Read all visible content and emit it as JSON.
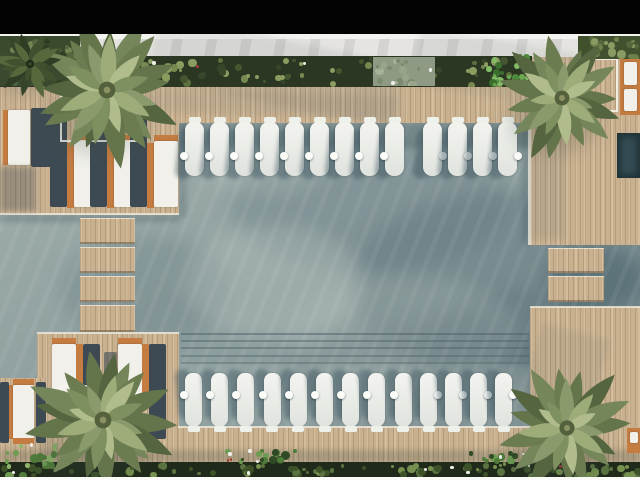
{
  "meta": {
    "title": "Aerial top-down render of resort swimming pool with sun deck",
    "type": "architectural-render",
    "visible_text": []
  },
  "palette": {
    "letterbox_black": "#030303",
    "walkway_white": "#f3f3f0",
    "marble_gray": "#e5e4e0",
    "deck_wood": "#c9b190",
    "water_base": "#95a5a4",
    "water_shadow": "#5a6f78",
    "lounger_white": "#f1f0ea",
    "lounger_frame_orange": "#c47c41",
    "furniture_shadow": "#3d4a53",
    "planter_green_dark": "#2b3722",
    "palm_green": "#7e8f60",
    "spa_teal": "#203439"
  },
  "scene": {
    "water_fx": [
      {
        "k": "blob",
        "x": 230,
        "y": 140,
        "w": 280,
        "h": 130,
        "c": "#5f757e",
        "o": 0.3
      },
      {
        "k": "blob",
        "x": 350,
        "y": 190,
        "w": 330,
        "h": 190,
        "c": "#5a6f78",
        "o": 0.36
      },
      {
        "k": "blob",
        "x": 60,
        "y": 235,
        "w": 170,
        "h": 110,
        "c": "#61767d",
        "o": 0.28
      },
      {
        "k": "blob",
        "x": 545,
        "y": 247,
        "w": 100,
        "h": 64,
        "c": "#3f5b65",
        "o": 0.45
      },
      {
        "k": "blob",
        "x": 290,
        "y": 320,
        "w": 300,
        "h": 120,
        "c": "#5e7077",
        "o": 0.28
      },
      {
        "k": "blob",
        "x": 420,
        "y": 290,
        "w": 230,
        "h": 150,
        "c": "#566c74",
        "o": 0.32
      },
      {
        "k": "blob",
        "x": 185,
        "y": 225,
        "w": 180,
        "h": 115,
        "c": "#c3cdc7",
        "o": 0.28
      },
      {
        "k": "blob",
        "x": 290,
        "y": 275,
        "w": 230,
        "h": 120,
        "c": "#bcc7c1",
        "o": 0.2
      },
      {
        "k": "blob",
        "x": 200,
        "y": 133,
        "w": 130,
        "h": 62,
        "c": "#c3cdc7",
        "o": 0.2
      },
      {
        "k": "blob",
        "x": 440,
        "y": 368,
        "w": 170,
        "h": 72,
        "c": "#b5c0ba",
        "o": 0.16
      },
      {
        "k": "streaks",
        "x": 0,
        "y": 86,
        "w": 640,
        "h": 380
      },
      {
        "k": "shade",
        "x": 178,
        "y": 122,
        "w": 352,
        "h": 26,
        "c": "#2a4049",
        "o": 0.28
      },
      {
        "k": "shade",
        "x": 179,
        "y": 122,
        "w": 7,
        "h": 95,
        "c": "#2a4049",
        "o": 0.25
      },
      {
        "k": "shade",
        "x": 522,
        "y": 122,
        "w": 8,
        "h": 123,
        "c": "#2a4049",
        "o": 0.22
      },
      {
        "k": "shade",
        "x": 0,
        "y": 215,
        "w": 179,
        "h": 7,
        "c": "#2a4049",
        "o": 0.25
      },
      {
        "k": "line",
        "x": 181,
        "y": 333,
        "w": 348,
        "h": 2,
        "c": "#4c6067",
        "o": 0.5
      },
      {
        "k": "line",
        "x": 181,
        "y": 340,
        "w": 348,
        "h": 2,
        "c": "#4c6067",
        "o": 0.45
      },
      {
        "k": "line",
        "x": 181,
        "y": 347,
        "w": 348,
        "h": 2,
        "c": "#4c6067",
        "o": 0.45
      },
      {
        "k": "line",
        "x": 181,
        "y": 355,
        "w": 348,
        "h": 2,
        "c": "#4c6067",
        "o": 0.4
      },
      {
        "k": "line",
        "x": 181,
        "y": 362,
        "w": 348,
        "h": 2,
        "c": "#4c6067",
        "o": 0.38
      },
      {
        "k": "shade",
        "x": 180,
        "y": 365,
        "w": 349,
        "h": 62,
        "c": "#cfd8d2",
        "o": 0.13
      }
    ],
    "decks": [
      {
        "k": "wood",
        "x": 0,
        "y": 86,
        "w": 640,
        "h": 37
      },
      {
        "k": "wood",
        "x": 530,
        "y": 57,
        "w": 110,
        "h": 188
      },
      {
        "k": "wood",
        "x": 530,
        "y": 307,
        "w": 110,
        "h": 158
      },
      {
        "k": "wood",
        "x": 0,
        "y": 86,
        "w": 179,
        "h": 129
      },
      {
        "k": "wood",
        "x": 37,
        "y": 333,
        "w": 142,
        "h": 132
      },
      {
        "k": "wood",
        "x": 0,
        "y": 378,
        "w": 46,
        "h": 87
      },
      {
        "k": "wood",
        "x": 178,
        "y": 427,
        "w": 462,
        "h": 38
      },
      {
        "k": "step",
        "x": 80,
        "y": 218,
        "w": 55,
        "h": 26
      },
      {
        "k": "step",
        "x": 80,
        "y": 247,
        "w": 55,
        "h": 26
      },
      {
        "k": "step",
        "x": 80,
        "y": 276,
        "w": 55,
        "h": 26
      },
      {
        "k": "step",
        "x": 80,
        "y": 305,
        "w": 55,
        "h": 27
      },
      {
        "k": "step",
        "x": 548,
        "y": 248,
        "w": 56,
        "h": 25
      },
      {
        "k": "step",
        "x": 548,
        "y": 276,
        "w": 56,
        "h": 26
      },
      {
        "k": "coping",
        "x": 528,
        "y": 120,
        "w": 3,
        "h": 125
      },
      {
        "k": "coping",
        "x": 530,
        "y": 306,
        "w": 110,
        "h": 2
      },
      {
        "k": "coping",
        "x": 178,
        "y": 426,
        "w": 352,
        "h": 2
      },
      {
        "k": "coping",
        "x": 0,
        "y": 213,
        "w": 179,
        "h": 2
      },
      {
        "k": "coping",
        "x": 37,
        "y": 332,
        "w": 142,
        "h": 2
      }
    ],
    "deck_shadows": [
      {
        "k": "shade",
        "x": 150,
        "y": 38,
        "w": 250,
        "h": 66,
        "c": "#55656b",
        "o": 0.1,
        "rot": 12
      },
      {
        "k": "shade",
        "x": 415,
        "y": 40,
        "w": 160,
        "h": 58,
        "c": "#55656b",
        "o": 0.09,
        "rot": 9
      },
      {
        "k": "shade",
        "x": 530,
        "y": 90,
        "w": 36,
        "h": 150,
        "c": "#4e5e63",
        "o": 0.12
      },
      {
        "k": "shade",
        "x": 140,
        "y": 92,
        "w": 260,
        "h": 24,
        "c": "#55656b",
        "o": 0.1,
        "rot": 2
      },
      {
        "k": "shade",
        "x": 530,
        "y": 330,
        "w": 70,
        "h": 90,
        "c": "#4e5e63",
        "o": 0.1,
        "rot": 15
      },
      {
        "k": "shade",
        "x": 0,
        "y": 450,
        "w": 640,
        "h": 13,
        "c": "#333f34",
        "o": 0.22
      }
    ],
    "furniture": [
      {
        "k": "frame",
        "x": 3,
        "y": 110,
        "w": 5,
        "h": 55
      },
      {
        "k": "cushion",
        "x": 8,
        "y": 110,
        "w": 22,
        "h": 55
      },
      {
        "k": "shadow",
        "x": 31,
        "y": 108,
        "w": 23,
        "h": 59
      },
      {
        "k": "shade",
        "x": 0,
        "y": 167,
        "w": 36,
        "h": 44,
        "c": "#3e4b54",
        "o": 0.35
      },
      {
        "k": "shadow",
        "x": 50,
        "y": 110,
        "w": 17,
        "h": 97
      },
      {
        "k": "frame",
        "x": 67,
        "y": 143,
        "w": 7,
        "h": 65
      },
      {
        "k": "cap",
        "x": 74,
        "y": 135,
        "w": 24,
        "h": 7
      },
      {
        "k": "cushion",
        "x": 74,
        "y": 141,
        "w": 24,
        "h": 66
      },
      {
        "k": "shadow",
        "x": 90,
        "y": 110,
        "w": 17,
        "h": 97
      },
      {
        "k": "frame",
        "x": 107,
        "y": 143,
        "w": 7,
        "h": 65
      },
      {
        "k": "cap",
        "x": 114,
        "y": 135,
        "w": 24,
        "h": 7
      },
      {
        "k": "cushion",
        "x": 114,
        "y": 141,
        "w": 24,
        "h": 66
      },
      {
        "k": "shadow",
        "x": 130,
        "y": 110,
        "w": 17,
        "h": 97
      },
      {
        "k": "frame",
        "x": 147,
        "y": 143,
        "w": 7,
        "h": 65
      },
      {
        "k": "cap",
        "x": 154,
        "y": 135,
        "w": 24,
        "h": 7
      },
      {
        "k": "cushion",
        "x": 154,
        "y": 141,
        "w": 24,
        "h": 66
      },
      {
        "k": "cap",
        "x": 52,
        "y": 338,
        "w": 24,
        "h": 7
      },
      {
        "k": "cushion",
        "x": 52,
        "y": 344,
        "w": 24,
        "h": 63
      },
      {
        "k": "cap",
        "x": 52,
        "y": 406,
        "w": 24,
        "h": 7
      },
      {
        "k": "frame",
        "x": 76,
        "y": 344,
        "w": 7,
        "h": 63
      },
      {
        "k": "shadow",
        "x": 83,
        "y": 344,
        "w": 17,
        "h": 95
      },
      {
        "k": "cap",
        "x": 118,
        "y": 338,
        "w": 24,
        "h": 7
      },
      {
        "k": "cushion",
        "x": 118,
        "y": 344,
        "w": 24,
        "h": 63
      },
      {
        "k": "cap",
        "x": 118,
        "y": 406,
        "w": 24,
        "h": 7
      },
      {
        "k": "frame",
        "x": 142,
        "y": 344,
        "w": 7,
        "h": 63
      },
      {
        "k": "shadow",
        "x": 149,
        "y": 344,
        "w": 17,
        "h": 95
      },
      {
        "k": "shadow",
        "x": 104,
        "y": 352,
        "w": 13,
        "h": 80,
        "o": 0.6
      },
      {
        "k": "shadow",
        "x": 0,
        "y": 382,
        "w": 9,
        "h": 61
      },
      {
        "k": "frame",
        "x": 9,
        "y": 385,
        "w": 4,
        "h": 54
      },
      {
        "k": "cap",
        "x": 13,
        "y": 379,
        "w": 21,
        "h": 6
      },
      {
        "k": "cushion",
        "x": 13,
        "y": 385,
        "w": 21,
        "h": 54
      },
      {
        "k": "cap",
        "x": 13,
        "y": 438,
        "w": 21,
        "h": 6
      },
      {
        "k": "shadow",
        "x": 36,
        "y": 382,
        "w": 10,
        "h": 61
      },
      {
        "k": "frame",
        "x": 620,
        "y": 58,
        "w": 20,
        "h": 57
      },
      {
        "k": "cushion",
        "x": 624,
        "y": 62,
        "w": 13,
        "h": 23
      },
      {
        "k": "cushion",
        "x": 624,
        "y": 89,
        "w": 13,
        "h": 22
      },
      {
        "k": "spa",
        "x": 617,
        "y": 133,
        "w": 23,
        "h": 45
      },
      {
        "k": "shade",
        "x": 621,
        "y": 137,
        "w": 15,
        "h": 37,
        "c": "#46626c",
        "o": 0.5
      },
      {
        "k": "frame",
        "x": 627,
        "y": 428,
        "w": 13,
        "h": 25
      },
      {
        "k": "cushion",
        "x": 630,
        "y": 432,
        "w": 8,
        "h": 11
      },
      {
        "k": "box",
        "x": 60,
        "y": 95,
        "w": 78,
        "h": 47
      },
      {
        "k": "box",
        "x": 586,
        "y": 58,
        "w": 32,
        "h": 54
      },
      {
        "k": "box",
        "x": 60,
        "y": 385,
        "w": 78,
        "h": 45
      }
    ],
    "pool_lounger_rows": [
      {
        "x": 185,
        "y": 122,
        "w": 19,
        "h": 54,
        "count": 9,
        "pitch": 25,
        "dot_y": 152,
        "dot_side": "left",
        "edge": "top"
      },
      {
        "x": 423,
        "y": 122,
        "w": 19,
        "h": 54,
        "count": 4,
        "pitch": 25,
        "dot_y": 152,
        "dot_side": "right",
        "edge": "top"
      },
      {
        "x": 185,
        "y": 373,
        "w": 17,
        "h": 54,
        "count": 9,
        "pitch": 26.2,
        "dot_y": 391,
        "dot_side": "left",
        "edge": "bottom"
      },
      {
        "x": 420,
        "y": 373,
        "w": 17,
        "h": 54,
        "count": 4,
        "pitch": 25,
        "dot_y": 391,
        "dot_side": "right",
        "edge": "bottom"
      }
    ],
    "plant_zones": [
      {
        "x": 0,
        "y": 56,
        "w": 532,
        "h": 31,
        "bg": "#2b3722",
        "n": 95,
        "palette": [
          "#44562f",
          "#5c7040",
          "#778950",
          "#36472a",
          "#8c9c61"
        ],
        "white": 6,
        "red": 3
      },
      {
        "x": 373,
        "y": 57,
        "w": 62,
        "h": 29,
        "bg": "#8f9a85",
        "n": 18,
        "palette": [
          "#a8b29b",
          "#7c8a6d",
          "#98a58a"
        ],
        "white": 2,
        "red": 0
      },
      {
        "x": 578,
        "y": 36,
        "w": 62,
        "h": 23,
        "bg": "#42512d",
        "n": 22,
        "palette": [
          "#55673c",
          "#6d7f4b",
          "#8a9a63"
        ],
        "white": 0,
        "red": 0
      },
      {
        "x": 0,
        "y": 36,
        "w": 80,
        "h": 50,
        "bg": "#3b4a2d",
        "n": 28,
        "palette": [
          "#2f3d22",
          "#55683f",
          "#738553",
          "#465733"
        ],
        "white": 0,
        "red": 0
      },
      {
        "x": 486,
        "y": 48,
        "w": 48,
        "h": 42,
        "bg": "",
        "n": 24,
        "palette": [
          "#4e8a3c",
          "#6aa94f",
          "#3c6e2e",
          "#83bb66"
        ],
        "white": 0,
        "red": 0
      },
      {
        "x": 0,
        "y": 462,
        "w": 640,
        "h": 15,
        "bg": "#1f2a1a",
        "n": 95,
        "palette": [
          "#3d5229",
          "#5a7340",
          "#76914f"
        ],
        "white": 7,
        "red": 3
      },
      {
        "x": 2,
        "y": 442,
        "w": 55,
        "h": 36,
        "bg": "",
        "n": 18,
        "palette": [
          "#4f7c3a",
          "#6e9c52",
          "#8fb56b"
        ],
        "white": 2,
        "red": 0
      },
      {
        "x": 225,
        "y": 448,
        "w": 75,
        "h": 16,
        "bg": "",
        "n": 16,
        "palette": [
          "#4f7c3a",
          "#6e9c52",
          "#2f4a24"
        ],
        "white": 3,
        "red": 2
      },
      {
        "x": 468,
        "y": 450,
        "w": 62,
        "h": 14,
        "bg": "",
        "n": 14,
        "palette": [
          "#4f7c3a",
          "#6e9c52",
          "#2f4a24"
        ],
        "white": 2,
        "red": 1
      }
    ],
    "palms": [
      {
        "cx": 107,
        "cy": 90,
        "r": 84,
        "fronds": 17,
        "dark": false
      },
      {
        "cx": 562,
        "cy": 98,
        "r": 74,
        "fronds": 15,
        "dark": false
      },
      {
        "cx": 103,
        "cy": 420,
        "r": 84,
        "fronds": 17,
        "dark": false
      },
      {
        "cx": 567,
        "cy": 428,
        "r": 76,
        "fronds": 15,
        "dark": false
      },
      {
        "cx": 30,
        "cy": 64,
        "r": 42,
        "fronds": 11,
        "dark": true
      }
    ]
  }
}
